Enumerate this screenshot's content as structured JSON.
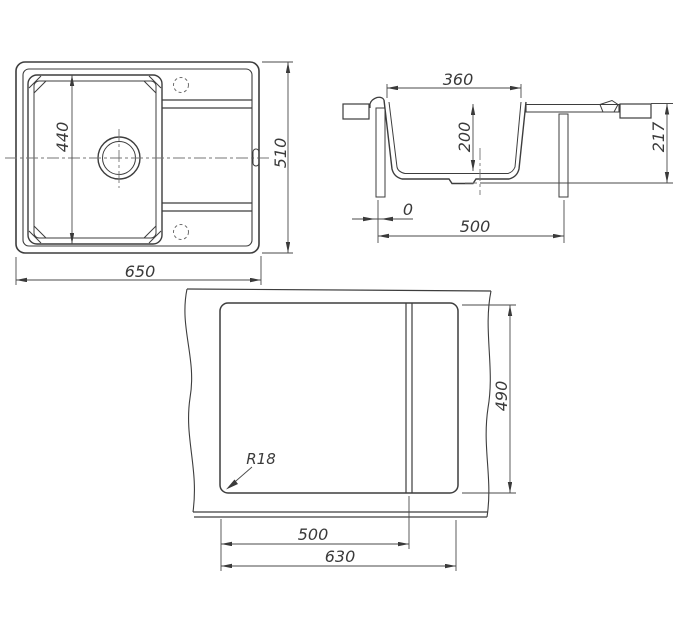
{
  "drawing": {
    "type": "sink-dimension-drawing",
    "views": {
      "plan": {
        "label": "plan-view",
        "dims": {
          "overall_width": "650",
          "overall_depth": "510",
          "bowl_length": "440"
        }
      },
      "section": {
        "label": "section-view",
        "dims": {
          "bowl_top_width": "360",
          "bowl_depth": "200",
          "overall_height": "217",
          "support_span": "500",
          "edge_offset": "0"
        }
      },
      "cutout": {
        "label": "cutout-template-view",
        "dims": {
          "cutout_width": "630",
          "main_section_width": "500",
          "cutout_depth": "490",
          "corner_radius": "R18"
        }
      }
    },
    "colors": {
      "line": "#3d3d3d",
      "dim_line": "#4a4a4a",
      "centerline": "#747474",
      "background": "#ffffff"
    }
  }
}
